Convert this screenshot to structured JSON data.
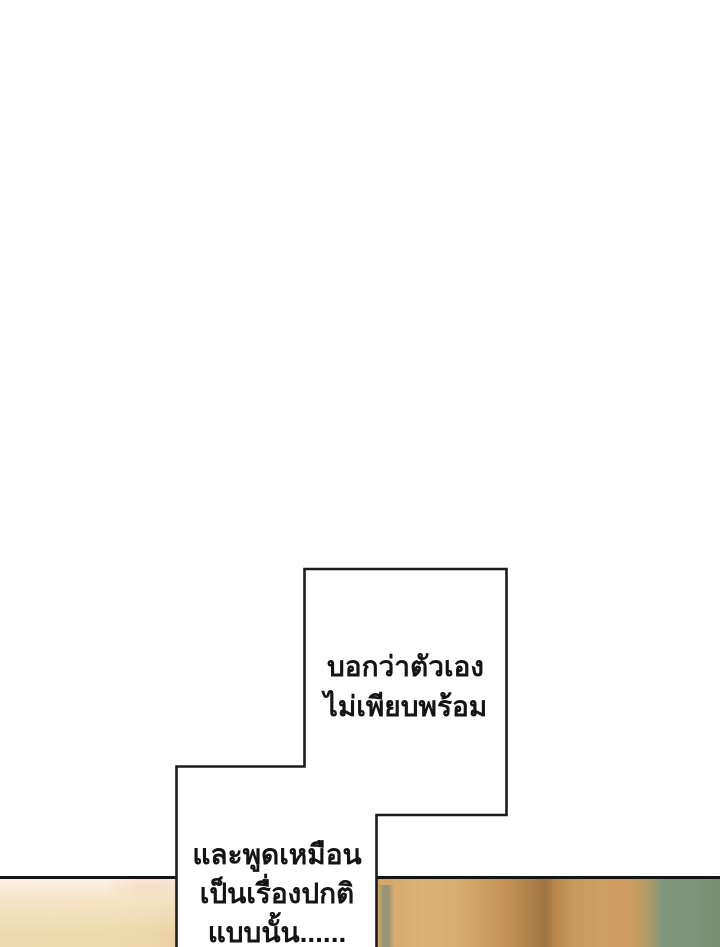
{
  "page": {
    "type": "comic-webtoon-page",
    "background_color": "#ffffff"
  },
  "speech": {
    "top_bubble": {
      "line1": "บอกว่าตัวเอง",
      "line2": "ไม่เพียบพร้อม"
    },
    "bottom_bubble": {
      "line1": "และพูดเหมือน",
      "line2": "เป็นเรื่องปกติ",
      "line3": "แบบนั้น......"
    }
  },
  "artwork": {
    "colors": {
      "page_bg": "#ffffff",
      "bubble_fill": "#ffffff",
      "bubble_border": "#1c1c1c",
      "panel_border": "#141414",
      "text_color": "#141414",
      "panel_cream_top": "#f4e6ce",
      "panel_cream_bottom": "#eed8ab",
      "panel_tan_light": "#dcb277",
      "panel_tan_dark": "#9f7442",
      "panel_olive_streak": "#8e9077",
      "panel_green": "#7e9779"
    }
  }
}
